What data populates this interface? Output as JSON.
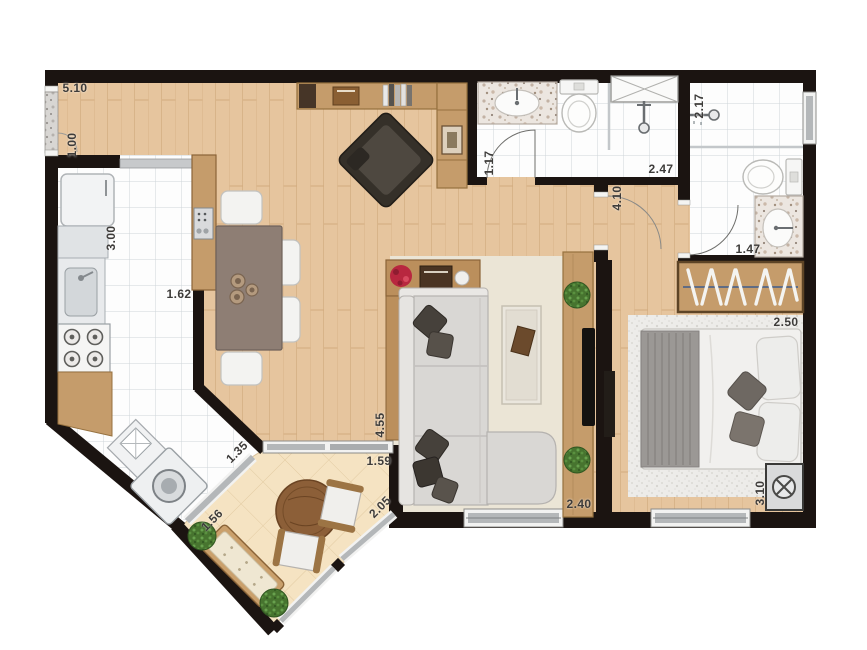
{
  "meta": {
    "title": "Apartment floor plan (top-down architectural drawing)",
    "units": "meters",
    "visible_text_type": "dimension labels only"
  },
  "palette": {
    "wall": "#1b1411",
    "wood_floor": "#e6c59e",
    "plank_line": "#cfa87b",
    "white_tile": "#fdfdfd",
    "tile_grid": "#ced5d9",
    "balcony_tile": "#f5e3c2",
    "living_rug": "#ebe5d6",
    "bedroom_rug": "#edece9",
    "furniture_wood": "#c59c6b",
    "dark_wood_edge": "#8a6337",
    "sofa_gray": "#d9d7d4",
    "pillow_dark": "#46413b",
    "window_glass_gray": "#b4b7b9",
    "label_text": "#3e3c3a"
  },
  "dimension_labels": [
    {
      "text": "5.10",
      "area": "entry-hall-top-width"
    },
    {
      "text": "1.00",
      "area": "entry-door-section"
    },
    {
      "text": "3.00",
      "area": "kitchen-length"
    },
    {
      "text": "1.62",
      "area": "kitchen-width"
    },
    {
      "text": "1.35",
      "area": "service-area-diagonal"
    },
    {
      "text": "1.56",
      "area": "balcony-left-edge"
    },
    {
      "text": "1.59",
      "area": "balcony-sliding-door"
    },
    {
      "text": "2.05",
      "area": "balcony-right-edge"
    },
    {
      "text": "4.55",
      "area": "living-room-length"
    },
    {
      "text": "2.40",
      "area": "living-room-width"
    },
    {
      "text": "1.17",
      "area": "bathroom1-width"
    },
    {
      "text": "2.47",
      "area": "bathroom1-length"
    },
    {
      "text": "4.10",
      "area": "hall-plus-bedroom-length"
    },
    {
      "text": "2.17",
      "area": "bathroom2-length"
    },
    {
      "text": "1.47",
      "area": "bathroom2-width"
    },
    {
      "text": "2.50",
      "area": "bedroom-width"
    },
    {
      "text": "3.10",
      "area": "bedroom-length"
    }
  ],
  "icons": {
    "fridge-icon": "rounded white rectangle",
    "kitchen-sink-icon": "steel basin with faucet",
    "stove-icon": "white cooktop with 4 burner rings",
    "washing-machine-icon": "tilted white box with round drum",
    "laundry-tank-icon": "tilted white box with X panel",
    "coffee-machine-icon": "small steel box with dot grid",
    "dining-table-icon": "taupe rectangle with 3 bowls",
    "dining-chair-icon": "white rounded square",
    "desk-shelf-icon": "wood band with books",
    "armchair-icon": "dark square rotated 45deg",
    "display-cabinet-icon": "wood column with framed art",
    "console-table-icon": "wood band with flowers, tray, plate",
    "sofa-icon": "light gray L-shape with chaise",
    "throw-pillow-icon": "dark gray diamond",
    "coffee-table-icon": "pale rectangle with brown tray",
    "tv-panel-icon": "wood strip with black flat TV",
    "plant-icon": "green textured circle",
    "bed-icon": "double bed, striped blanket and pillows",
    "closet-icon": "wood bar with clothes hangers",
    "ac-unit-icon": "steel box with fan cross circle",
    "toilet-icon": "white oval bowl with tank",
    "bathroom-sink-icon": "marble counter with oval basin",
    "shower-head-icon": "rod with round head",
    "shower-niche-icon": "white box with X cross",
    "round-table-icon": "wood circle",
    "bench-icon": "tilted wood bench with cream cushion",
    "window-icon": "gray glazing bar in white frame",
    "sliding-door-icon": "gray glazing bar in white frame",
    "door-swing-icon": "quarter-circle arc",
    "entry-door-icon": "granite threshold strip"
  }
}
